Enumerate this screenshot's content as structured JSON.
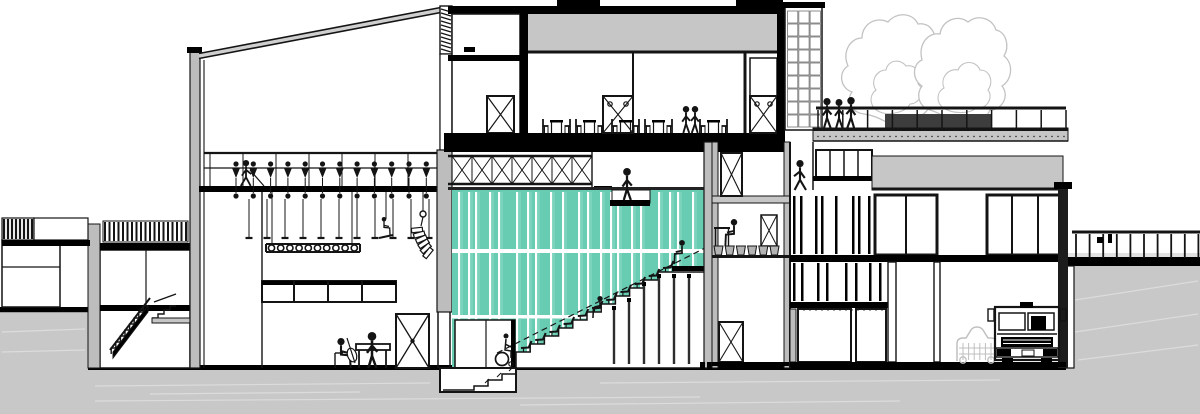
{
  "meta": {
    "type": "architectural-section-drawing",
    "subject": "cross-section of a theatre / concert hall building",
    "canvas": {
      "w": 1200,
      "h": 414
    }
  },
  "colors": {
    "line": "#141414",
    "paper": "#ffffff",
    "earth": "#c8c8c8",
    "earth_streak": "#dcdcdc",
    "wall": "#bdbdbd",
    "slab": "#c6c6c6",
    "dark": "#000000",
    "teal": "#67ccb2",
    "teal_streak": "#8fdac7",
    "seam": "#ffffff",
    "tree": "#c2c2c2",
    "car": "#bfbfbf",
    "hedge": "#3d3d3d",
    "pot": "#b4b4b4",
    "tile_line": "#707070",
    "strut": "#2e2e2e",
    "edge_light": "#e2e2e2"
  },
  "counts": {
    "fly_lines": 11,
    "hoist_winches": 12,
    "truss_lamps": 10,
    "speaker_array_boxes": 6,
    "tribune_steps": 11,
    "tribune_struts": 6,
    "restaurant_table_groups": 3,
    "roof_trees": 2,
    "tower_tile_rows": 9,
    "tower_tile_cols": 3,
    "terrace_rail_posts": 11,
    "embankment_rail_posts": 10,
    "office_planter_pots": 6,
    "stage_window_panes": 4,
    "teal_stripe_pattern": [
      10,
      7,
      14,
      9,
      18,
      11,
      8,
      15,
      12,
      16,
      9,
      13
    ]
  },
  "figures": [
    {
      "role": "stage-technician-on-fly-gallery",
      "pose": "walking"
    },
    {
      "role": "rigger-on-bosun-chair",
      "pose": "seated"
    },
    {
      "role": "cellist-on-stage",
      "pose": "seated"
    },
    {
      "role": "musician-at-piano-table",
      "pose": "standing"
    },
    {
      "role": "visitor-on-lighting-bridge",
      "pose": "standing"
    },
    {
      "role": "restaurant-guest",
      "pose": "standing",
      "count": 2
    },
    {
      "role": "wheelchair-user-at-tribune",
      "pose": "seated"
    },
    {
      "role": "spectator-on-tribune",
      "pose": "seated",
      "count": 2
    },
    {
      "role": "office-worker-at-desk",
      "pose": "seated"
    },
    {
      "role": "person-on-upper-walkway",
      "pose": "walking"
    },
    {
      "role": "visitor-on-roof-terrace",
      "pose": "standing",
      "count": 3
    }
  ],
  "objects": {
    "vehicles": [
      "box-truck",
      "car-silhouette"
    ],
    "stage_props": [
      "cello",
      "piano-table",
      "road-case"
    ],
    "rigging": [
      "fly-bars",
      "lighting-truss",
      "line-array-speaker",
      "bosun-chair"
    ],
    "landscape": [
      "roof-terrace-trees",
      "planter-hedge",
      "embankment-guardrail"
    ]
  }
}
